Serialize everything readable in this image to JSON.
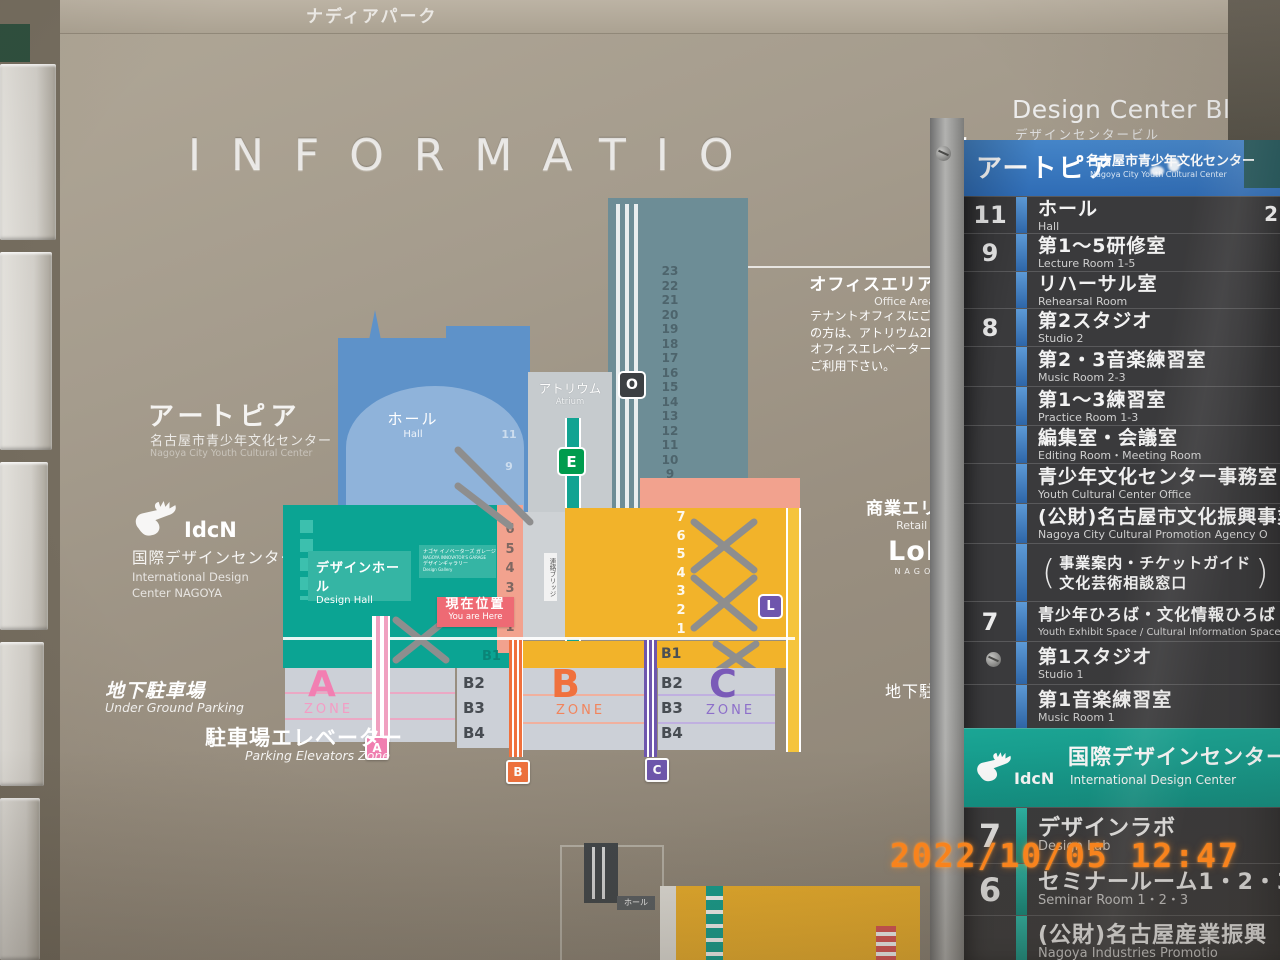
{
  "photo": {
    "timestamp": "2022/10/05 12:47"
  },
  "sign": {
    "park_name": "ナディアパーク",
    "info_title_main": "INFORMATIO",
    "info_title_last": "N",
    "building_en": "Design Center Bldg.",
    "building_jp": "デザインセンタービル"
  },
  "left_labels": {
    "artopia": {
      "title": "アートピア",
      "jp": "名古屋市青少年文化センター",
      "en": "Nagoya City Youth Cultural Center"
    },
    "idcn": {
      "logo_text": "IdcN",
      "jp": "国際デザインセンター",
      "en_line1": "International Design",
      "en_line2": "Center NAGOYA"
    }
  },
  "areas": {
    "office": {
      "jp": "オフィスエリア",
      "en": "Office Area",
      "note_lines": [
        "テナントオフィスにご用",
        "の方は、アトリウム2Fの",
        "オフィスエレベーターを",
        "ご利用下さい。"
      ]
    },
    "retail": {
      "jp": "商業エリア",
      "en": "Retail Area",
      "loft": "LoFt",
      "loft_sub": "NAGOYA"
    },
    "parking_left": {
      "jp": "地下駐車場",
      "en": "Under Ground Parking"
    },
    "parking_right": {
      "jp": "地下駐車場",
      "en": "Parking"
    },
    "parking_elevator": {
      "jp": "駐車場エレベーター",
      "en": "Parking Elevators Zone"
    }
  },
  "map": {
    "hall": {
      "jp": "ホール",
      "en": "Hall"
    },
    "atrium": {
      "jp": "アトリウム",
      "en": "Atrium"
    },
    "design_hall": {
      "jp": "デザインホール",
      "en": "Design Hall"
    },
    "garage": {
      "jp1": "ナゴヤ イノベーターズ ガレージ",
      "en1": "NAGOYA INNOVATOR'S GARAGE",
      "jp2": "デザインギャラリー",
      "en2": "Design Gallery"
    },
    "bridge": "連絡ブリッジ",
    "you_are_here": {
      "jp": "現在位置",
      "en": "You are Here"
    },
    "badge_o": "O",
    "badge_e": "E",
    "badge_l": "L",
    "badge_a": "A",
    "badge_b": "B",
    "badge_c": "C",
    "tower_floors": [
      "23",
      "22",
      "21",
      "20",
      "19",
      "18",
      "17",
      "16",
      "15",
      "14",
      "13",
      "12",
      "11",
      "10",
      "9",
      "8"
    ],
    "hall_floors": [
      "11",
      "9"
    ],
    "mid_floors": [
      "6",
      "5",
      "4",
      "3",
      "2",
      "1"
    ],
    "retail_floors": [
      "7",
      "6",
      "5",
      "4",
      "3",
      "2",
      "1"
    ],
    "b1_left": "B1",
    "b1_right": "B1",
    "basement_floors": [
      "B2",
      "B3",
      "B4"
    ],
    "zones": {
      "a": {
        "letter": "A",
        "word": "ZONE"
      },
      "b": {
        "letter": "B",
        "word": "ZONE"
      },
      "c": {
        "letter": "C",
        "word": "ZONE"
      }
    },
    "fragment_hall": "ホール"
  },
  "directory": {
    "header": {
      "title": "アートピア",
      "jp": "名古屋市青少年文化センター",
      "en": "Nagoya City Youth Cultural Center"
    },
    "edge_digit": "2",
    "rows": [
      {
        "floor": "11",
        "jp": "ホール",
        "en": "Hall"
      },
      {
        "floor": "9",
        "jp": "第1〜5研修室",
        "en": "Lecture Room 1-5"
      },
      {
        "floor": "",
        "jp": "リハーサル室",
        "en": "Rehearsal Room"
      },
      {
        "floor": "8",
        "jp": "第2スタジオ",
        "en": "Studio 2"
      },
      {
        "floor": "",
        "jp": "第2・3音楽練習室",
        "en": "Music Room 2-3"
      },
      {
        "floor": "",
        "jp": "第1〜3練習室",
        "en": "Practice Room 1-3"
      },
      {
        "floor": "",
        "jp": "編集室・会議室",
        "en": "Editing Room・Meeting Room"
      },
      {
        "floor": "",
        "jp": "青少年文化センター事務室",
        "en": "Youth Cultural Center Office"
      },
      {
        "floor": "",
        "jp": "(公財)名古屋市文化振興事業",
        "en": "Nagoya City Cultural Promotion Agency O"
      },
      {
        "floor": "",
        "jp1": "事業案内・チケットガイド",
        "jp2": "文化芸術相談窓口",
        "paren_open": "(",
        "paren_close": ")"
      },
      {
        "floor": "7",
        "jp": "青少年ひろば・文化情報ひろば",
        "en": "Youth Exhibit Space / Cultural Information Space"
      },
      {
        "floor": "",
        "jp": "第1スタジオ",
        "en": "Studio 1"
      },
      {
        "floor": "",
        "jp": "第1音楽練習室",
        "en": "Music Room 1"
      }
    ],
    "idcn_band": {
      "logo_text": "IdcN",
      "jp": "国際デザインセンター",
      "en": "International Design Center"
    },
    "lower_rows": [
      {
        "floor": "7",
        "jp": "デザインラボ",
        "en": "Design Lab"
      },
      {
        "floor": "6",
        "jp": "セミナールーム1・2・3",
        "en": "Seminar Room 1・2・3"
      },
      {
        "floor": "",
        "jp": "(公財)名古屋産業振興",
        "en": "Nagoya Industries Promotio"
      }
    ]
  }
}
